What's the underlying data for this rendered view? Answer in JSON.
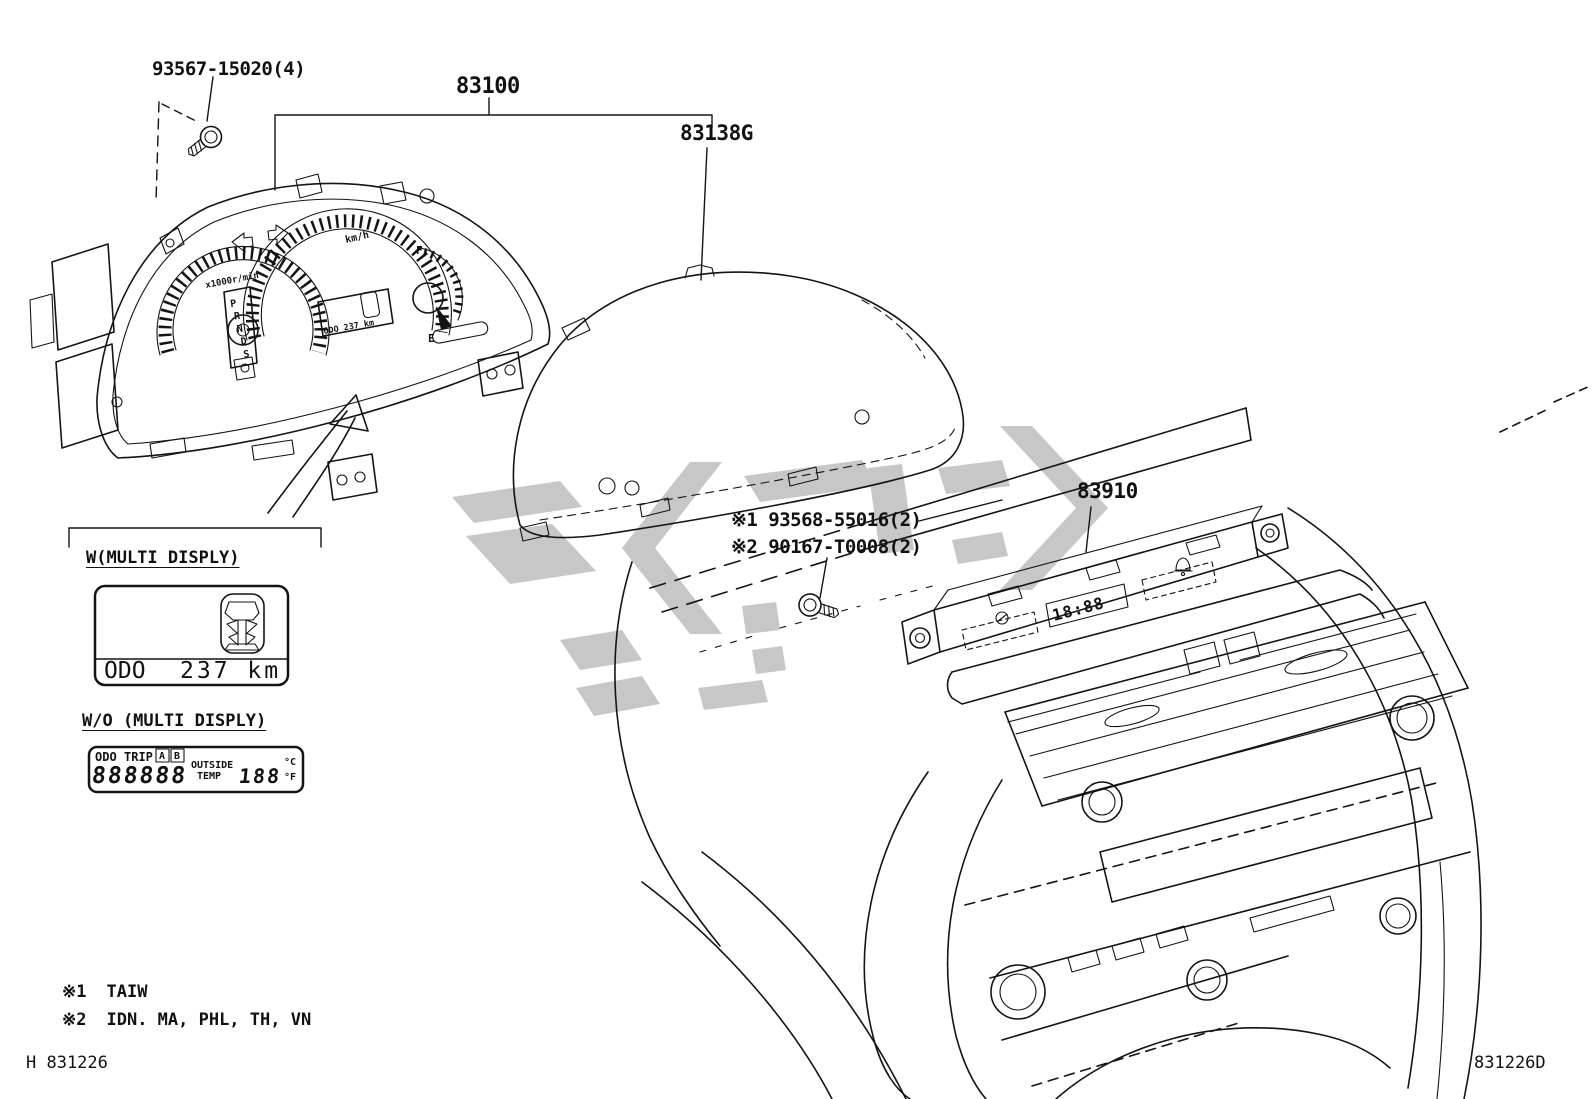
{
  "colors": {
    "line": "#141414",
    "watermark": "#c7c7c7",
    "background": "#ffffff"
  },
  "part_labels": {
    "screw_top": "93567-15020(4)",
    "cluster_assembly": "83100",
    "meter_glass": "83138G",
    "center_display": "83910",
    "note1": "※1 93568-55016(2)",
    "note2": "※2 90167-T0008(2)"
  },
  "legend": {
    "with_multi": {
      "title": "W(MULTI DISPLY)",
      "odo_label": "ODO",
      "odo_value": "237 km"
    },
    "without_multi": {
      "title": "W/O (MULTI DISPLY)",
      "lcd": {
        "odo": "ODO",
        "trip": "TRIP",
        "btn_a": "A",
        "btn_b": "B",
        "digits": "888888",
        "outside": "OUTSIDE",
        "temp": "TEMP",
        "temp_value": "188",
        "unit_c": "°C",
        "unit_f": "°F"
      }
    }
  },
  "footnotes": {
    "n1_mark": "※1",
    "n1_text": "TAIW",
    "n2_mark": "※2",
    "n2_text": "IDN. MA, PHL, TH, VN"
  },
  "page": {
    "code_left": "H 831226",
    "code_right": "831226D"
  },
  "drawing": {
    "speedo_unit": "km/h",
    "tach_unit": "x1000r/min",
    "gear": [
      "P",
      "R",
      "N",
      "D",
      "S"
    ],
    "cluster_odo": "ODO 237 km",
    "fuel_full": "F",
    "fuel_empty": "E",
    "center_lcd": "18:88"
  }
}
